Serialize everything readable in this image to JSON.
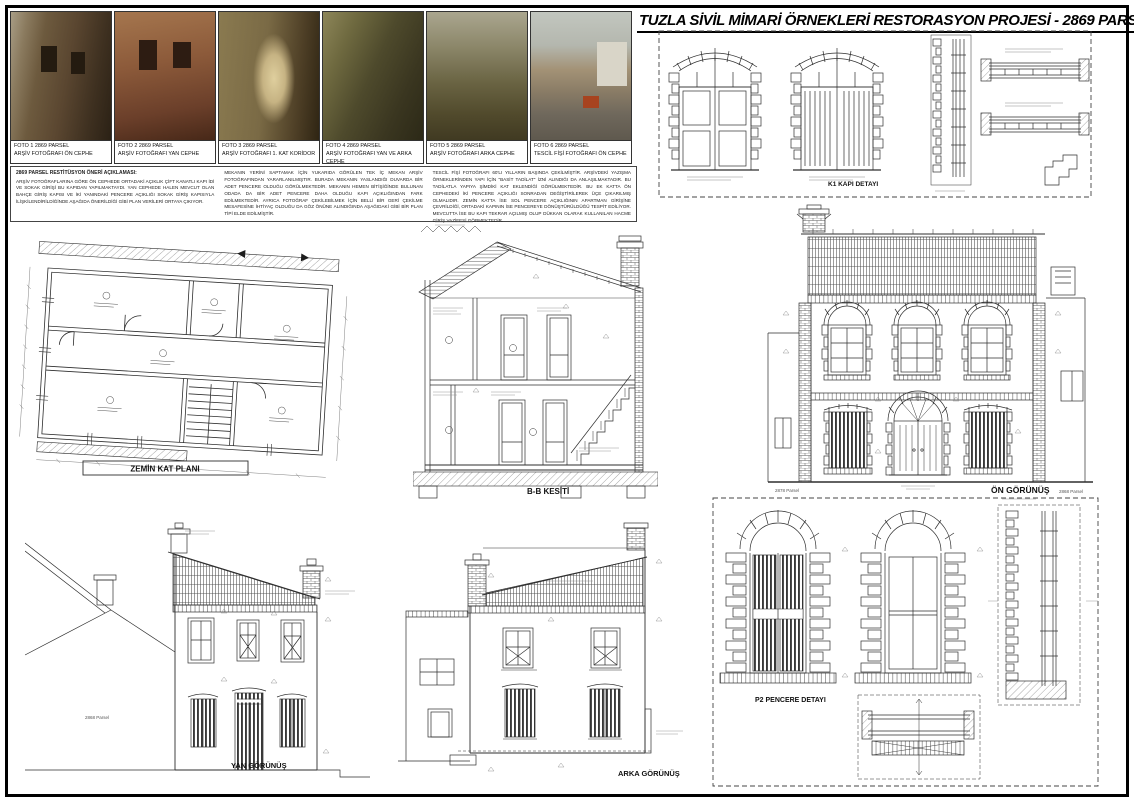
{
  "sheet": {
    "title": "TUZLA SİVİL MİMARİ ÖRNEKLERİ RESTORASYON PROJESİ - 2869 PARSEL"
  },
  "photos": [
    {
      "line1": "FOTO 1 2869 PARSEL",
      "line2": "ARŞİV FOTOĞRAFI ÖN CEPHE"
    },
    {
      "line1": "FOTO 2 2869 PARSEL",
      "line2": "ARŞİV FOTOĞRAFI YAN CEPHE"
    },
    {
      "line1": "FOTO 3 2869 PARSEL",
      "line2": "ARŞİV FOTOĞRAFI 1. KAT KORİDOR"
    },
    {
      "line1": "FOTO 4 2869 PARSEL",
      "line2": "ARŞİV FOTOĞRAFI YAN VE ARKA CEPHE"
    },
    {
      "line1": "FOTO 5 2869 PARSEL",
      "line2": "ARŞİV FOTOĞRAFI ARKA CEPHE"
    },
    {
      "line1": "FOTO 6 2869 PARSEL",
      "line2": "TESCİL FİŞİ FOTOĞRAFI ÖN CEPHE"
    }
  ],
  "description": {
    "heading": "2869 PARSEL RESTİTÜSYON ÖNERİ AÇIKLAMASI:",
    "col1": "ARŞİV FOTOĞRAFLARINA GÖRE ÖN CEPHEDE ORTADAKİ AÇIKLIK ÇİFT KANATLI KAPI İDİ VE SOKAK GİRİŞİ BU KAPIDAN YAPILMAKTAYDI. YAN CEPHEDE HALEN MEVCUT OLAN BAHÇE GİRİŞ KAPISI VE İKİ YANINDAKİ PENCERE AÇIKLIĞI SOKAK GİRİŞ KAPISIYLA İLİŞKİLENDİRİLDİĞİNDE AŞAĞIDA ÖNERİLDİĞİ GİBİ PLAN VERİLERİ ORTAYA ÇIKIYOR.",
    "col2": "MEKANIN YERİNİ SAPTAMAK İÇİN YUKARIDA GÖRÜLEN TEK İÇ MEKAN ARŞİV FOTOĞRAFINDAN YARARLANILMIŞTIR. BURADA MEKANIN YASLANDIĞI DUVARDA BİR ADET PENCERE OLDUĞU GÖRÜLMEKTEDİR. MEKANIN HEMEN BİTİŞİĞİNDE BULUNAN ODADA DA BİR ADET PENCERE DAHA OLDUĞU KAPI AÇIKLIĞINDAN FARK EDİLMEKTEDİR. AYRICA FOTOĞRAF ÇEKİLEBİLMEK İÇİN BELLİ BİR GERİ ÇEKİLME MESAFESİNE İHTİYAÇ OLDUĞU DA GÖZ ÖNÜNE ALINDIĞINDA AŞAĞIDAKİ GİBİ BİR PLAN TİPİ ELDE EDİLMİŞTİR.",
    "col3": "TESCİL FİŞİ FOTOĞRAFI 60'LI YILLARIN BAŞINDA ÇEKİLMİŞTİR. ARŞİVDEKİ YAZIŞMA ÖRNEKLERİNDEN YAPI İÇİN \"BASİT TADİLAT\" İZNİ ALINDIĞI DA ANLAŞILMAKTADIR. BU TADİLATLA YAPIYA ŞİMDİKİ KAT EKLENDİĞİ GÖRÜLMEKTEDİR. BU EK KATTA ÖN CEPHEDEKİ İKİ PENCERE AÇIKLIĞI SONRADAN DEĞİŞTİRİLEREK ÜÇE ÇIKARILMIŞ OLMALIDIR. ZEMİN KATTA İSE SOL PENCERE AÇIKLIĞININ APARTMAN GİRİŞİNE ÇEVRİLDİĞİ, ORTADAKİ KAPININ İSE PENCEREYE DÖNÜŞTÜRÜLDÜĞÜ TESPİT EDİLİYOR. MEVCUTTA İSE BU KAPI TEKRAR AÇILMIŞ OLUP DÜKKAN OLARAK KULLANILAN HACME GİRİŞ VAZİFESİ GÖRMEKTEDİR."
  },
  "drawings": {
    "floor_plan": {
      "label": "ZEMİN KAT PLANI"
    },
    "section": {
      "label": "B-B KESİTİ"
    },
    "front_elevation": {
      "label": "ÖN GÖRÜNÜŞ",
      "left_parcel": "2878 Parsel",
      "right_parcel": "2868 Parsel"
    },
    "door_detail": {
      "label": "K1 KAPI DETAYI"
    },
    "side_elevation": {
      "label": "YAN GÖRÜNÜŞ",
      "neighbor_parcel": "2868 Parsel"
    },
    "rear_elevation": {
      "label": "ARKA GÖRÜNÜŞ"
    },
    "window_detail": {
      "label": "P2 PENCERE DETAYI"
    }
  },
  "colors": {
    "ink": "#2e2e2e",
    "paper": "#ffffff",
    "frame": "#000000"
  }
}
